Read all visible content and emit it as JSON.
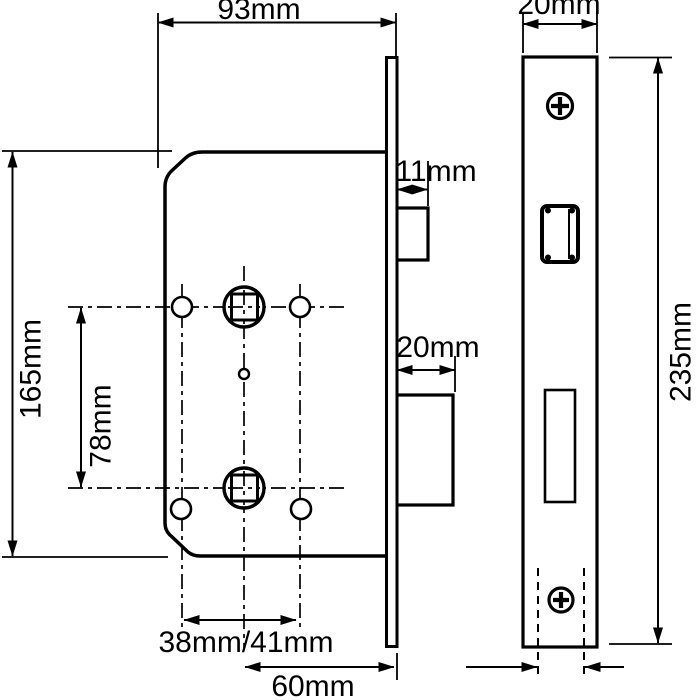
{
  "dimensions": {
    "case_width": "93mm",
    "faceplate_width": "20mm",
    "latch_projection": "11mm",
    "deadbolt_projection": "20mm",
    "case_height": "165mm",
    "follower_centres": "78mm",
    "faceplate_height": "235mm",
    "backset_options": "38mm/41mm",
    "spindle_backset": "60mm"
  },
  "values_mm": {
    "case_width": 93,
    "faceplate_width": 20,
    "latch_projection": 11,
    "deadbolt_projection": 20,
    "case_height": 165,
    "follower_centres": 78,
    "faceplate_height": 235,
    "backset_options": [
      38,
      41
    ],
    "spindle_backset": 60
  },
  "colors": {
    "line": "#000000",
    "background": "#ffffff"
  }
}
